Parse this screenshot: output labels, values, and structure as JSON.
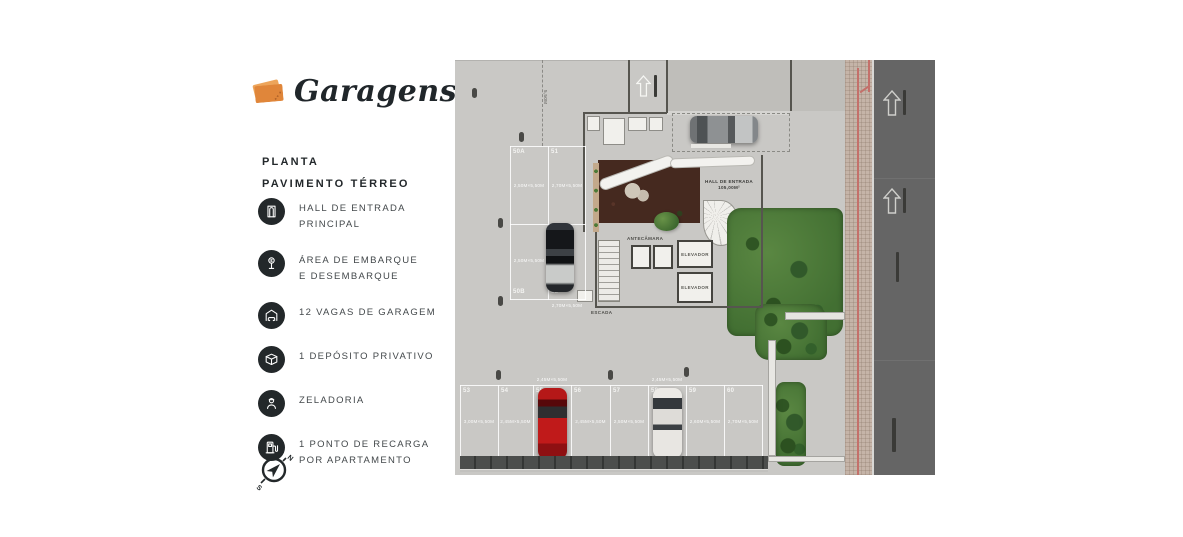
{
  "sidebar": {
    "logo_text": "Garagens",
    "plan_title_line1": "PLANTA",
    "plan_title_line2": "PAVIMENTO TÉRREO",
    "legend": [
      {
        "icon": "entrance-door-icon",
        "line1": "HALL DE ENTRADA",
        "line2": "PRINCIPAL"
      },
      {
        "icon": "boarding-sign-icon",
        "line1": "ÁREA DE EMBARQUE",
        "line2": "E DESEMBARQUE"
      },
      {
        "icon": "garage-car-icon",
        "line1": "12 VAGAS DE GARAGEM",
        "line2": ""
      },
      {
        "icon": "deposit-box-icon",
        "line1": "1 DEPÓSITO PRIVATIVO",
        "line2": ""
      },
      {
        "icon": "caretaker-icon",
        "line1": "ZELADORIA",
        "line2": ""
      },
      {
        "icon": "ev-charging-icon",
        "line1": "1 PONTO DE RECARGA",
        "line2": "POR APARTAMENTO"
      }
    ],
    "compass": {
      "north": "N",
      "south": "S"
    }
  },
  "plan": {
    "hall_label_line1": "HALL DE ENTRADA",
    "hall_label_line2": "105,00M²",
    "labels": {
      "elevator": "ELEVADOR",
      "stairs": "ESCADA",
      "antechamber": "ANTECÂMARA"
    },
    "top_dim": "5,50M",
    "left_spots": [
      {
        "id": "50A",
        "dim": "2,50M×5,50M"
      },
      {
        "id": "51",
        "dim": "2,70M×5,50M"
      },
      {
        "id": "50B",
        "dim": "2,50M×5,50M"
      },
      {
        "id": "52",
        "dim": "2,70M×5,50M"
      }
    ],
    "bottom_spots": [
      {
        "id": "53",
        "dim": "3,00M×5,50M"
      },
      {
        "id": "54",
        "dim": "2,45M×5,50M"
      },
      {
        "id": "55",
        "dim": "2,45M×5,50M"
      },
      {
        "id": "56",
        "dim": "2,45M×5,50M"
      },
      {
        "id": "57",
        "dim": "2,50M×5,50M"
      },
      {
        "id": "58",
        "dim": "2,45M×5,50M"
      },
      {
        "id": "59",
        "dim": "2,60M×5,50M"
      },
      {
        "id": "60",
        "dim": "2,70M×5,50M"
      }
    ],
    "colors": {
      "plan_bg": "#c9c8c5",
      "road": "#656565",
      "sidewalk": "#c5b4a8",
      "red_line": "#c4706a",
      "hall_floor": "#45291f",
      "green": "#426f32",
      "car_red": "#c01a1a",
      "logo_orange": "#e0863a",
      "ink": "#23282b"
    }
  }
}
